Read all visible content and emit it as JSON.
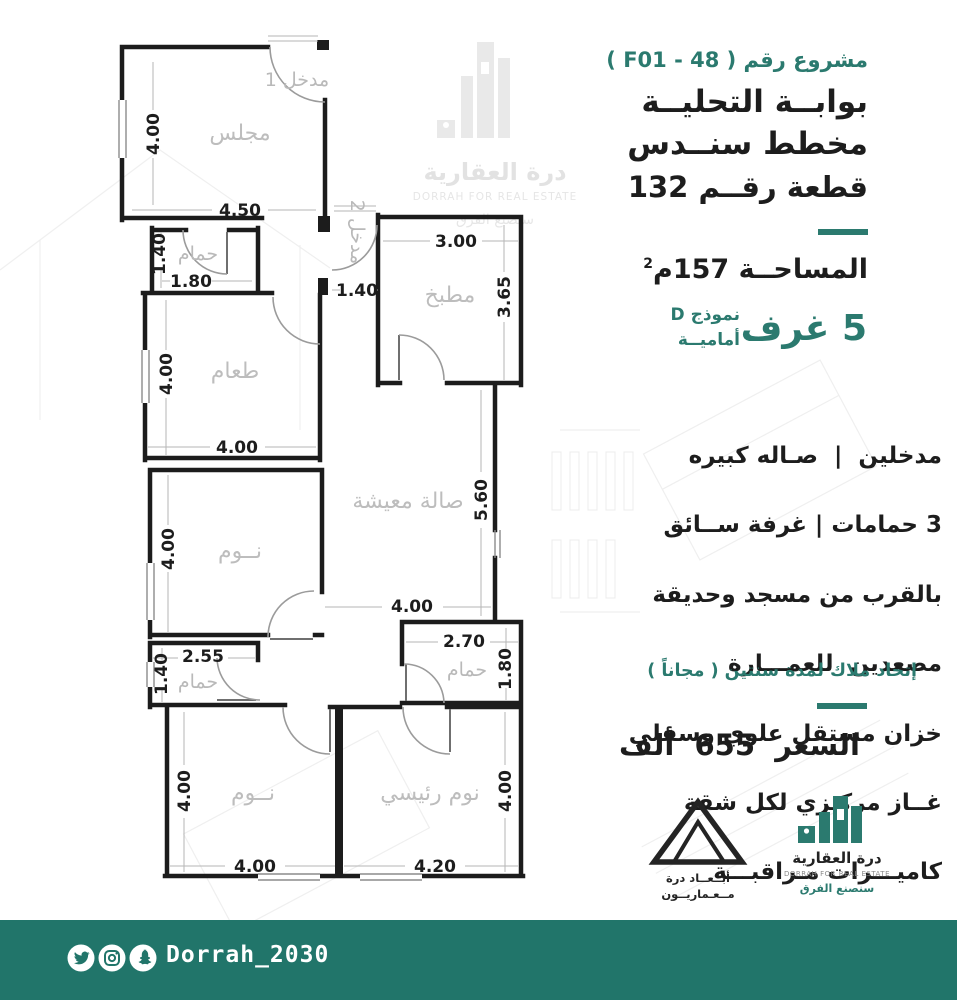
{
  "colors": {
    "accent": "#2b7a6f",
    "bar": "#21756a",
    "wall": "#1c1c1c",
    "room_label": "#bdbdbd"
  },
  "header": {
    "project": "مشروع رقم ( F01 - 48 )",
    "title1": "بوابــة التحليــة",
    "title2": "مخطط سنــدس",
    "plot": "قطعة رقــم 132"
  },
  "area": {
    "text": "المساحــة 157م",
    "sup": "2"
  },
  "model": {
    "rooms": "5 غرف",
    "type": "نموذج D",
    "facing": "أماميــة"
  },
  "features": [
    "مدخلين  |  صـاله كبيره",
    "3 حمامات | غرفة ســائق",
    "بالقرب من مسجد وحديقة",
    "مصعدين  للعمـــارة",
    "خزان مستقل علوي وسفلي",
    "غــاز مركـزي لكل شقة",
    "كاميـــرات مـراقبـــة",
    "موقـف سيــارة خـاص"
  ],
  "hoa_note": "إتحاد ملاك لمدة سنتين ( مجاناً )",
  "price": "السعر  655  ألف",
  "logos": {
    "abaad": {
      "line1": "أبــعــاد درة",
      "line2": "مــعـماريــون"
    },
    "dorrah": {
      "ar": "درة العقارية",
      "en": "DORRAH FOR REAL ESTATE",
      "slogan": "سنصنع الفرق"
    }
  },
  "watermark": {
    "ar": "درة العقارية",
    "en": "DORRAH FOR REAL ESTATE",
    "slogan": "سنصنع الفرق"
  },
  "footer": {
    "handle": "Dorrah_2030",
    "social_icons": [
      "twitter",
      "instagram",
      "snapchat"
    ]
  },
  "floor_plan": {
    "rooms": {
      "majlis": "مجلس",
      "entrance1": "مدخل 1",
      "entrance2": "مدخل 2",
      "bath1": "حمام",
      "kitchen": "مطبخ",
      "dining": "طعام",
      "bedroom1": "نــوم",
      "living": "صالة معيشة",
      "bath2": "حمام",
      "bath3": "حمام",
      "bedroom2": "نــوم",
      "master": "نوم رئيسي"
    },
    "dims": {
      "majlis_h": "4.00",
      "majlis_w": "4.50",
      "bath1_h": "1.40",
      "bath1_w": "1.80",
      "ent2_w": "1.40",
      "kitchen_w": "3.00",
      "kitchen_h": "3.65",
      "dining_h": "4.00",
      "dining_w": "4.00",
      "bed1_h": "4.00",
      "living_h": "5.60",
      "living_w": "4.00",
      "bath2_w": "2.55",
      "bath2_h": "1.40",
      "bath3_w": "2.70",
      "bath3_h": "1.80",
      "bed2_h": "4.00",
      "bed2_w": "4.00",
      "master_w": "4.20",
      "master_h": "4.00"
    }
  }
}
